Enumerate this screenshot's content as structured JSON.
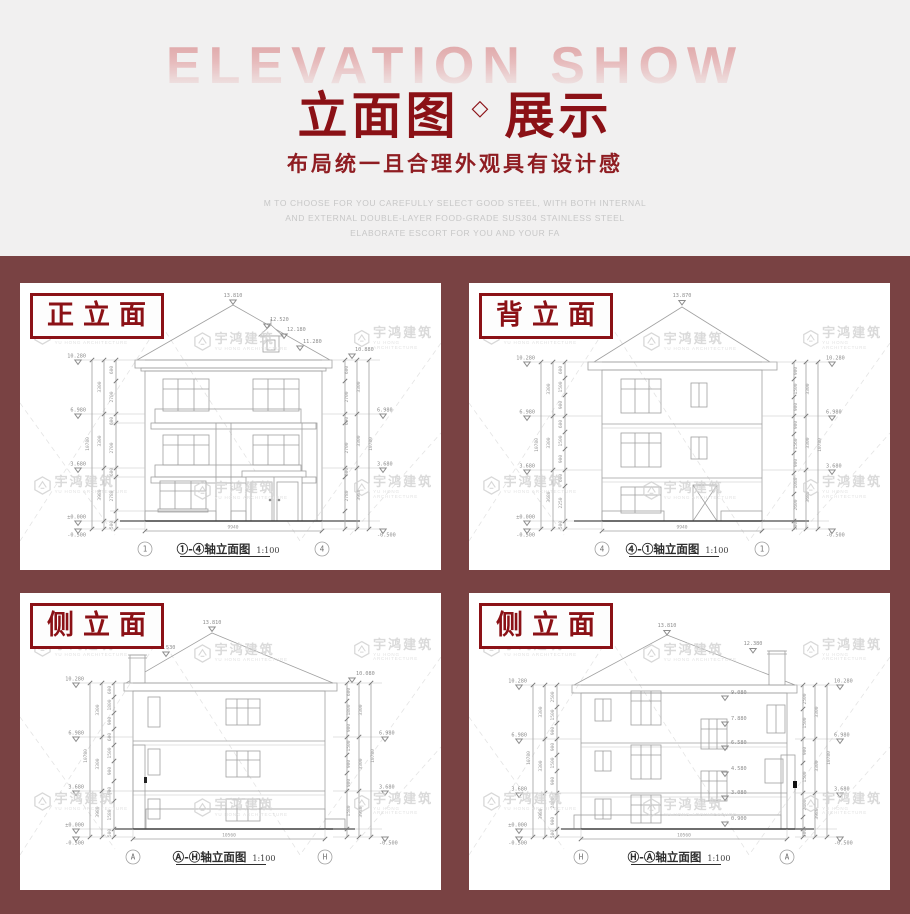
{
  "header": {
    "background_title": "ELEVATION SHOW",
    "title_left": "立面图",
    "title_diamond": "◇",
    "title_right": "展示",
    "subtitle": "布局统一且合理外观具有设计感",
    "fineprint": [
      "M TO CHOOSE FOR YOU CAREFULLY SELECT GOOD STEEL, WITH BOTH INTERNAL",
      "AND EXTERNAL DOUBLE-LAYER FOOD-GRADE SUS304 STAINLESS STEEL",
      "ELABORATE ESCORT FOR YOU AND YOUR FA"
    ]
  },
  "watermark": {
    "cn": "宇鸿建筑",
    "en": "YU HONG ARCHITECTURE"
  },
  "colors": {
    "accent_red": "#8b1116",
    "main_bg": "#794243",
    "header_bg": "#f1f0f0",
    "drawing_line": "#a0a0a0"
  },
  "panels": [
    {
      "label": "正立面",
      "caption": "①-④轴立面图",
      "scale": "1:100",
      "axis_left": "1",
      "axis_right": "4",
      "width_dim": "9940",
      "dim_total": "10780",
      "dims_mid": [
        "3300",
        "3300",
        "3980"
      ],
      "dims_small": [
        "600",
        "2700",
        "600",
        "2700",
        "600",
        "2780",
        "500"
      ],
      "elev_marks": [
        "10.280",
        "6.980",
        "3.680",
        "±0.000",
        "-0.500"
      ],
      "roof_marks": [
        "13.810",
        "12.520",
        "12.180",
        "11.280",
        "10.880"
      ]
    },
    {
      "label": "背立面",
      "caption": "④-①轴立面图",
      "scale": "1:100",
      "axis_left": "4",
      "axis_right": "1",
      "width_dim": "9940",
      "dim_total": "10780",
      "dims_mid": [
        "3300",
        "3300",
        "3680"
      ],
      "dims_small_left": [
        "600",
        "1500",
        "900",
        "600",
        "1500",
        "900",
        "600",
        "2250",
        "500"
      ],
      "dims_small_right": [
        "900",
        "1500",
        "900",
        "900",
        "1560",
        "900",
        "1080",
        "2600",
        "500"
      ],
      "elev_marks": [
        "10.280",
        "6.980",
        "3.680",
        "±0.000",
        "-0.500"
      ],
      "roof_marks": [
        "13.870"
      ]
    },
    {
      "label": "侧立面",
      "caption": "Ⓐ-Ⓗ轴立面图",
      "scale": "1:100",
      "axis_left": "A",
      "axis_right": "H",
      "width_dim": "10560",
      "dim_total": "10780",
      "dims_mid": [
        "3300",
        "3300",
        "3980"
      ],
      "dims_small": [
        "600",
        "1800",
        "900",
        "600",
        "1500",
        "900",
        "900",
        "1580",
        "500"
      ],
      "elev_marks": [
        "10.280",
        "6.980",
        "3.680",
        "±0.000",
        "-0.500"
      ],
      "roof_marks": [
        "13.810",
        "12.530",
        "10.080"
      ]
    },
    {
      "label": "侧立面",
      "caption": "Ⓗ-Ⓐ轴立面图",
      "scale": "1:100",
      "axis_left": "H",
      "axis_right": "A",
      "width_dim": "10560",
      "dim_total": "10780",
      "dims_mid": [
        "3300",
        "3300",
        "3980"
      ],
      "dims_small": [
        "2500",
        "1500",
        "900",
        "900",
        "1500",
        "900",
        "2400",
        "900",
        "500"
      ],
      "elev_marks": [
        "10.280",
        "6.980",
        "3.680",
        "±0.000",
        "-0.500"
      ],
      "roof_marks": [
        "13.810",
        "12.380"
      ],
      "stair_marks": [
        "9.080",
        "7.880",
        "6.580",
        "4.580",
        "3.080",
        "0.900"
      ]
    }
  ]
}
